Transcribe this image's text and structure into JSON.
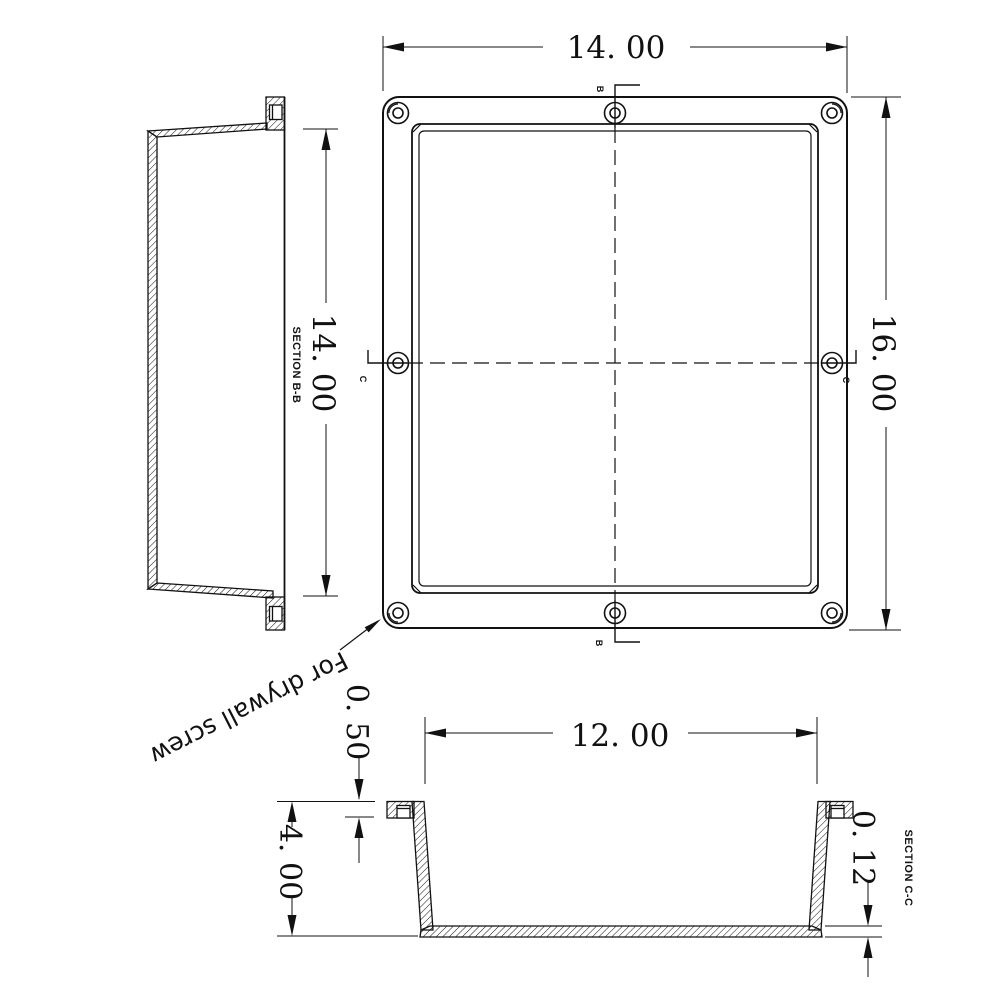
{
  "drawing": {
    "annotation": {
      "text": "For drywall screw"
    },
    "front_view": {
      "width_dim": "14. 00",
      "height_dim": "16. 00",
      "section_marker_top": "B",
      "section_marker_bottom": "B",
      "section_marker_left": "C",
      "section_marker_right": "C"
    },
    "side_view": {
      "label": "SECTION B-B",
      "height_dim": "14. 00"
    },
    "bottom_view": {
      "label": "SECTION C-C",
      "opening_dim": "12. 00",
      "flange_dim": "0. 50",
      "depth_dim": "4. 00",
      "bottom_thickness_dim": "0. 12"
    },
    "colors": {
      "line": "#111111",
      "background": "#ffffff"
    }
  }
}
